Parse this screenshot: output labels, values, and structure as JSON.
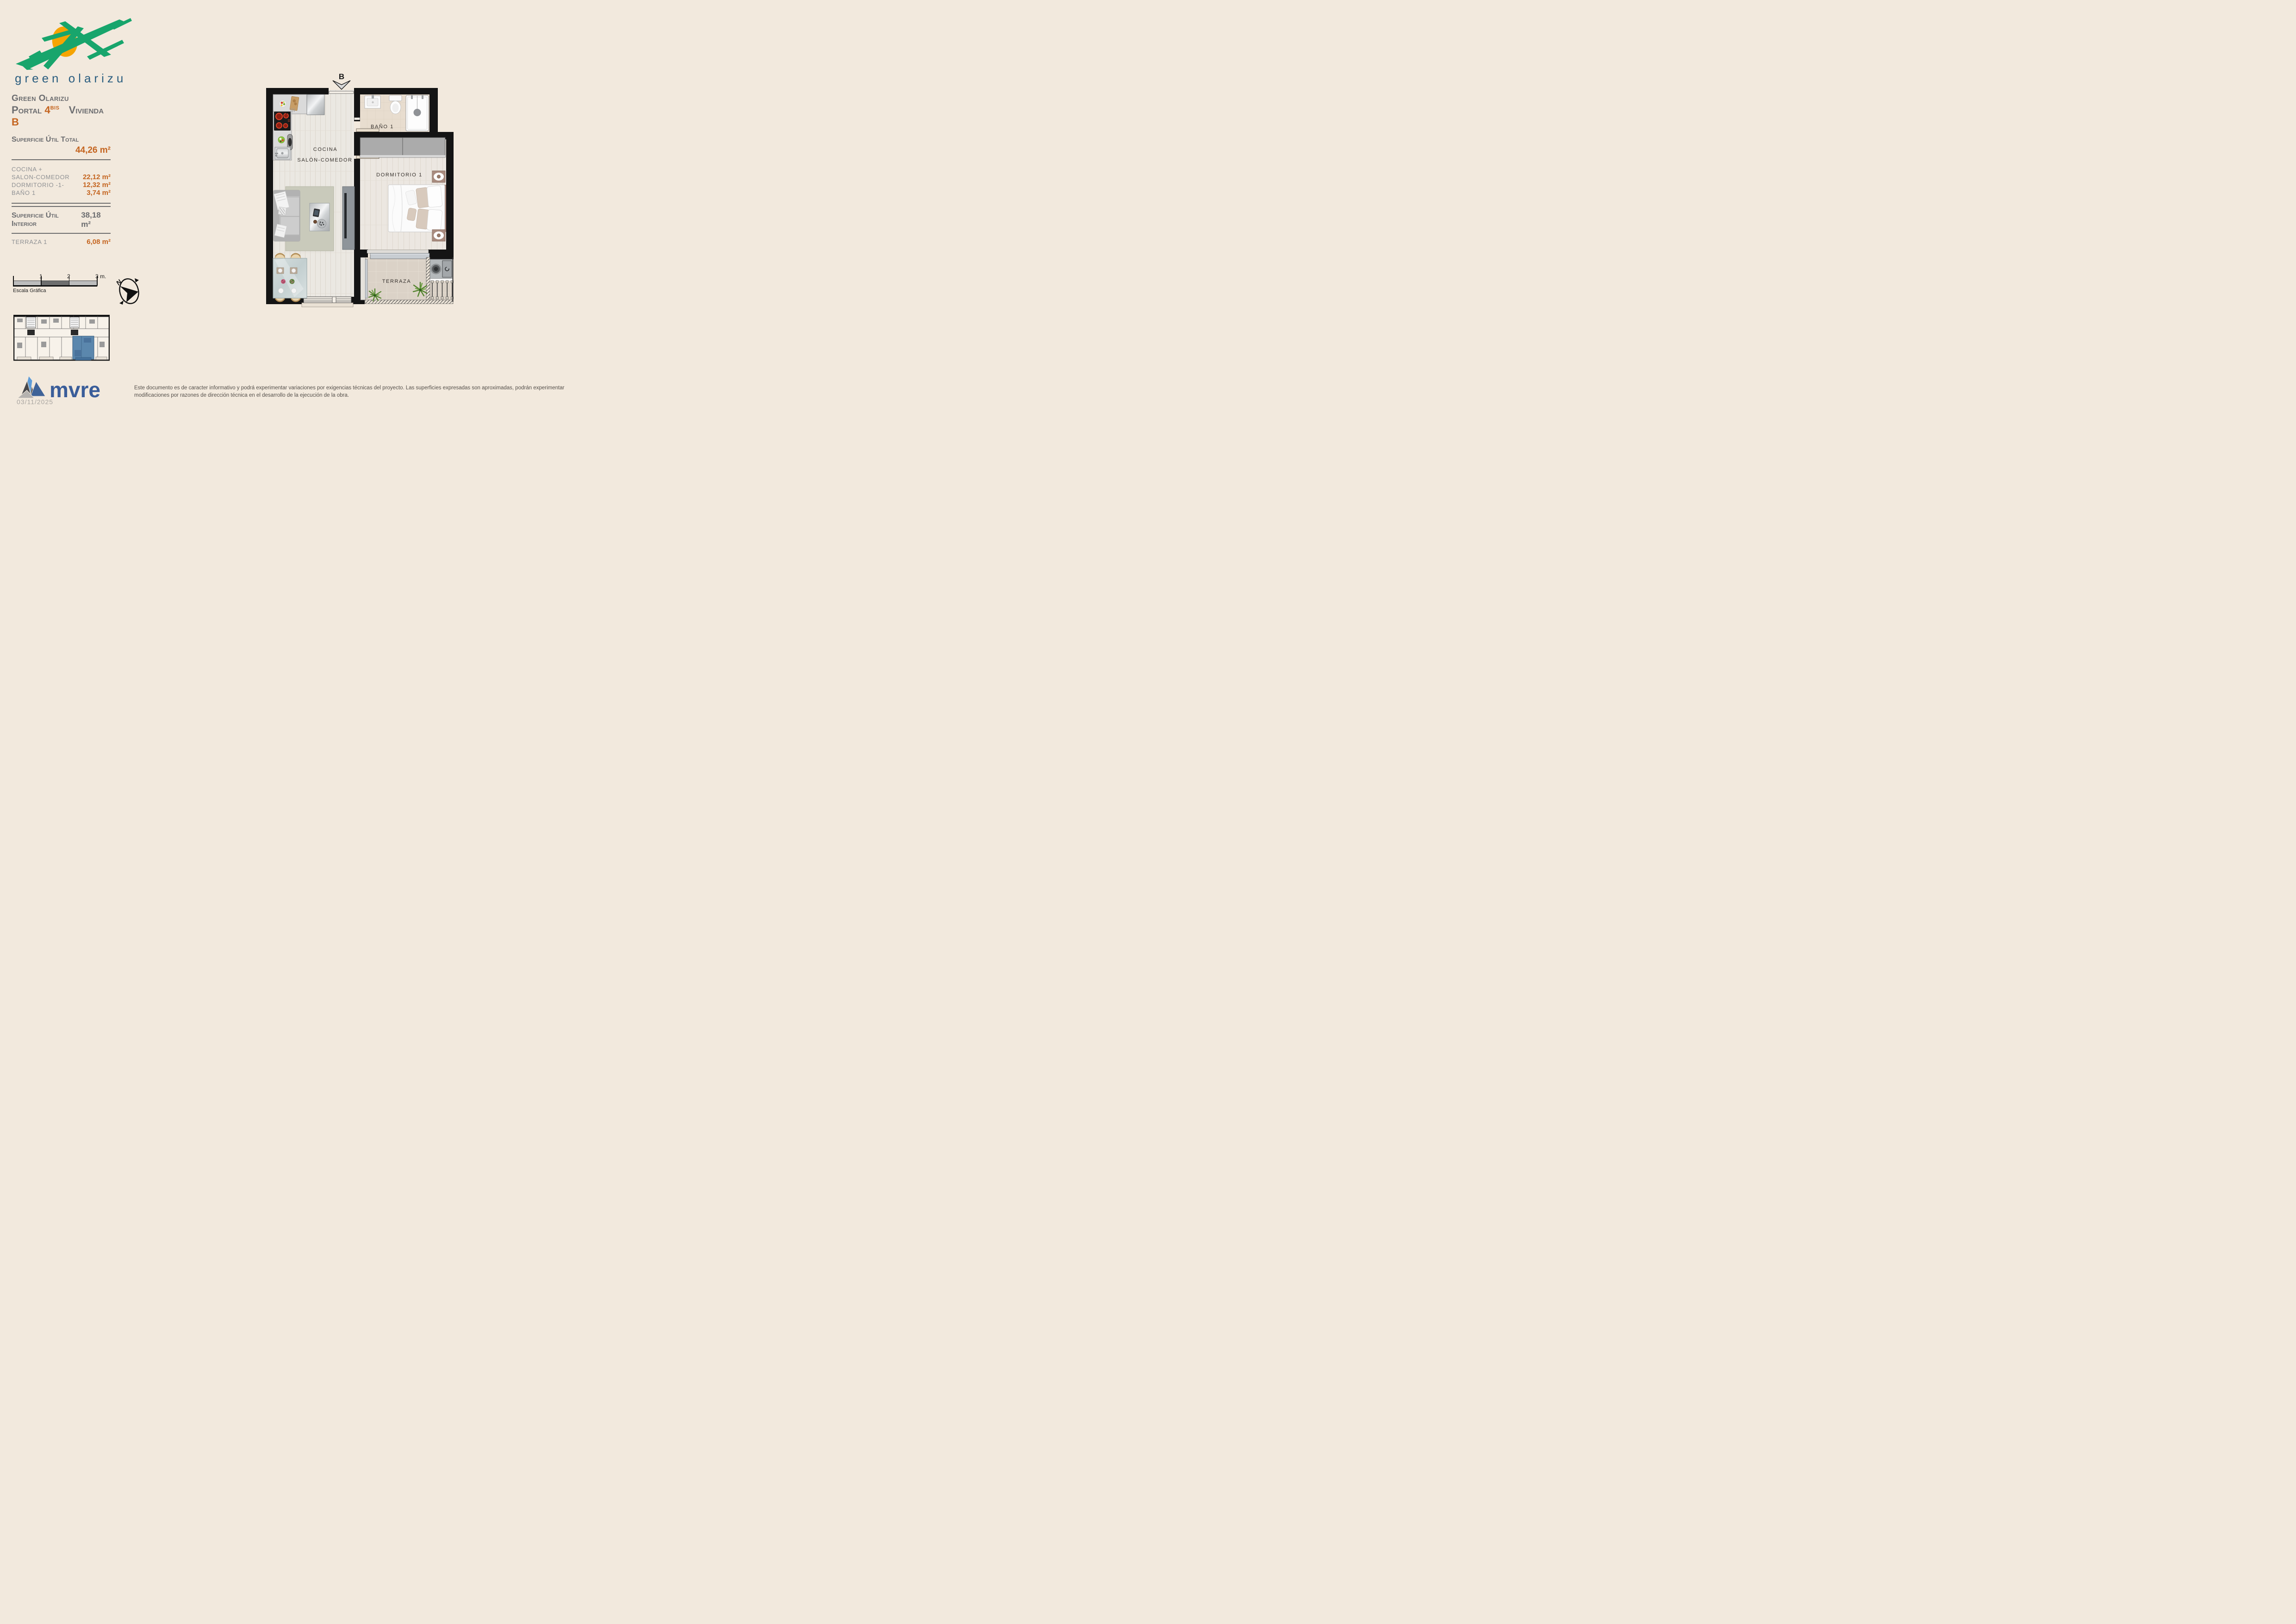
{
  "logo": {
    "wordmark": "green olarizu"
  },
  "header": {
    "project": "Green Olarizu",
    "portal_label": "Portal",
    "portal_number": "4",
    "portal_sup": "BIS",
    "vivienda_label": "Vivienda",
    "vivienda_letter": "B"
  },
  "surfaces": {
    "total_label": "Superficie Útil Total",
    "total_value": "44,26 m²",
    "rooms": [
      {
        "label": "COCINA +",
        "value": ""
      },
      {
        "label": "SALON-COMEDOR",
        "value": "22,12 m²"
      },
      {
        "label": "DORMITORIO -1-",
        "value": "12,32 m²"
      },
      {
        "label": "BAÑO 1",
        "value": "3,74 m²"
      }
    ],
    "interior_label": "Superficie Útil Interior",
    "interior_value": "38,18 m²",
    "terrace_label": "TERRAZA 1",
    "terrace_value": "6,08 m²"
  },
  "scale_bar": {
    "tick_1": "1",
    "tick_2": "2",
    "tick_3": "3 m.",
    "caption": "Escala Gráfica"
  },
  "compass": {
    "north": "N"
  },
  "floor_plan": {
    "entrance_label": "B",
    "labels": {
      "kitchen": "COCINA",
      "living": "SALÓN-COMEDOR",
      "bath": "BAÑO 1",
      "bedroom": "DORMITORIO 1",
      "terrace": "TERRAZA"
    }
  },
  "footer": {
    "brand": "mvre",
    "date": "03/11/2025",
    "disclaimer": "Este documento es de caracter informativo y podrá experimentar variaciones por exigencias técnicas del proyecto. Las superficies expresadas son aproximadas, podrán experimentar modificaciones por razones de dirección técnica en el desarrollo de la ejecución de la obra."
  },
  "colors": {
    "background_cream": "#f2e9dd",
    "accent_orange": "#c4641f",
    "text_gray": "#6c6d70",
    "brand_green": "#18a56c",
    "sun_orange": "#f5a402",
    "wordmark_blue": "#2a5d7f",
    "mvre_blue": "#3a5d99",
    "keyplan_highlight": "#5b87ad",
    "wall_black": "#141414"
  }
}
